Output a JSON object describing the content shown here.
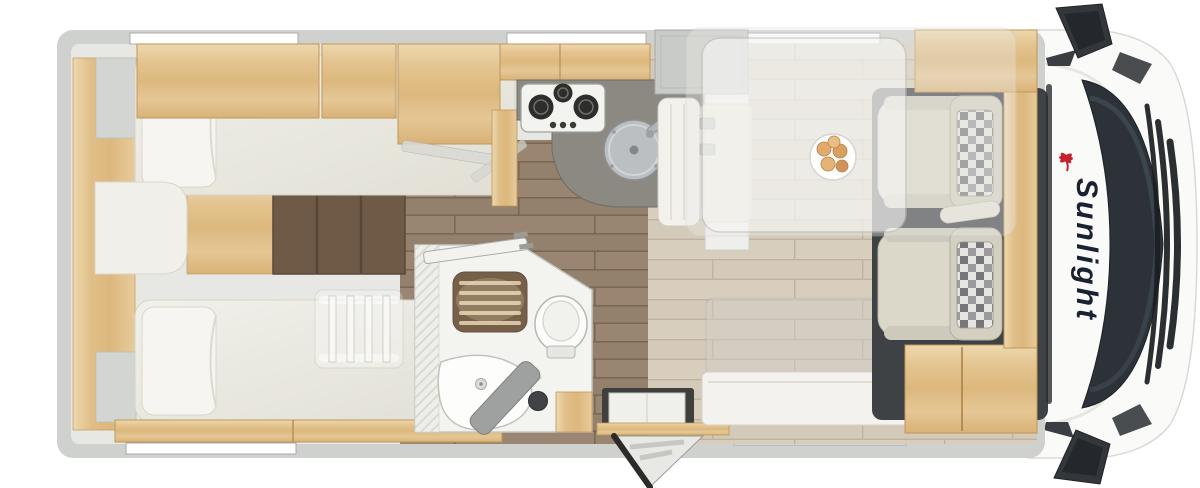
{
  "page": {
    "title": "Sunlight motorhome floor plan - top view"
  },
  "vehicle": {
    "brand": "Sunlight",
    "view": "top-down floor plan",
    "brand_text_color": "#1a2130",
    "brand_logo_color": "#c4222f"
  },
  "areas": {
    "rear_bedroom": {
      "label": "Twin single beds",
      "items": [
        "top single bed",
        "bottom single bed",
        "pillows",
        "center filler cushion",
        "wood steps",
        "bunk ladder",
        "wardrobe",
        "overhead cabinets"
      ]
    },
    "kitchen": {
      "label": "Kitchen",
      "items": [
        "3-burner gas hob",
        "round covered sink",
        "dark worktop",
        "overhead cabinets",
        "base cabinet"
      ]
    },
    "bathroom": {
      "label": "Bathroom",
      "items": [
        "shower with wood grate",
        "toilet",
        "washbasin",
        "folding door",
        "wood cabinet",
        "open bathroom door"
      ]
    },
    "dinette": {
      "label": "Half dinette",
      "items": [
        "forward bench",
        "side bench",
        "translucent table",
        "plate with bread rolls",
        "drop-down bed overlay",
        "sideboard"
      ]
    },
    "entry": {
      "label": "Entrance",
      "items": [
        "entry step well",
        "wood threshold",
        "open entry door"
      ]
    },
    "cab": {
      "label": "Driver cab",
      "items": [
        "driver seat",
        "passenger seat",
        "checkered seat fabric",
        "windshield",
        "front grille",
        "side mirrors",
        "wood partition"
      ]
    }
  },
  "palette": {
    "wall_grey": "#cfd1ce",
    "inner_lining": "#e7e8e4",
    "wood_light": "#e3c38e",
    "wood_dark_steps": "#6e5a47",
    "floor_brown": "#94816d",
    "floor_dinette": "#d4cab9",
    "mattress_cream": "#edebe2",
    "counter_dark": "#8b8982",
    "seat_beige": "#dbd7c9",
    "windshield_dark": "#2c3238",
    "logo_red": "#c4222f"
  }
}
